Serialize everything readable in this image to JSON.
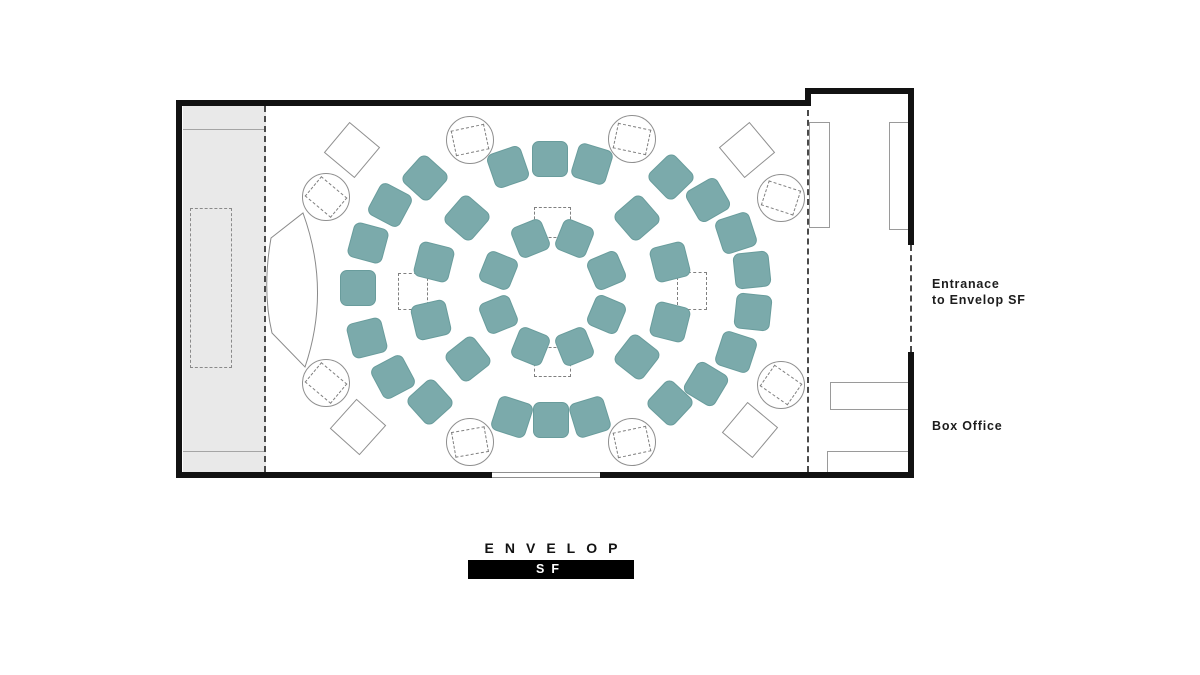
{
  "labels": {
    "entrance_line1": "Entranace",
    "entrance_line2": "to Envelop SF",
    "box_office": "Box Office",
    "logo_text": "ENVELOP",
    "logo_sub": "SF"
  },
  "colors": {
    "seat": "#7baaab",
    "seat_border": "#699c9c",
    "wall": "#121212",
    "stage": "#e9e9e9"
  },
  "floorplan": {
    "seats": [
      {
        "x": 574,
        "y": 238,
        "rot": 22,
        "s": 33
      },
      {
        "x": 606,
        "y": 270,
        "rot": 67,
        "s": 33
      },
      {
        "x": 606,
        "y": 314,
        "rot": 113,
        "s": 33
      },
      {
        "x": 574,
        "y": 346,
        "rot": 158,
        "s": 33
      },
      {
        "x": 530,
        "y": 346,
        "rot": 202,
        "s": 33
      },
      {
        "x": 498,
        "y": 314,
        "rot": 248,
        "s": 33
      },
      {
        "x": 498,
        "y": 270,
        "rot": 292,
        "s": 33
      },
      {
        "x": 530,
        "y": 238,
        "rot": 338,
        "s": 33
      },
      {
        "x": 467,
        "y": 218,
        "rot": 311,
        "s": 36
      },
      {
        "x": 434,
        "y": 262,
        "rot": 284,
        "s": 36
      },
      {
        "x": 431,
        "y": 320,
        "rot": 257,
        "s": 36
      },
      {
        "x": 468,
        "y": 359,
        "rot": 232,
        "s": 36
      },
      {
        "x": 637,
        "y": 218,
        "rot": 49,
        "s": 36
      },
      {
        "x": 670,
        "y": 262,
        "rot": 76,
        "s": 36
      },
      {
        "x": 670,
        "y": 322,
        "rot": 104,
        "s": 36
      },
      {
        "x": 637,
        "y": 357,
        "rot": 128,
        "s": 36
      },
      {
        "x": 508,
        "y": 167,
        "rot": 341,
        "s": 36
      },
      {
        "x": 550,
        "y": 159,
        "rot": 0,
        "s": 36
      },
      {
        "x": 592,
        "y": 164,
        "rot": 17,
        "s": 36
      },
      {
        "x": 671,
        "y": 177,
        "rot": 46,
        "s": 36
      },
      {
        "x": 708,
        "y": 200,
        "rot": 60,
        "s": 36
      },
      {
        "x": 736,
        "y": 233,
        "rot": 72,
        "s": 36
      },
      {
        "x": 752,
        "y": 270,
        "rot": 84,
        "s": 36
      },
      {
        "x": 753,
        "y": 312,
        "rot": 96,
        "s": 36
      },
      {
        "x": 736,
        "y": 352,
        "rot": 108,
        "s": 36
      },
      {
        "x": 706,
        "y": 384,
        "rot": 121,
        "s": 36
      },
      {
        "x": 670,
        "y": 403,
        "rot": 133,
        "s": 36
      },
      {
        "x": 590,
        "y": 417,
        "rot": 163,
        "s": 36
      },
      {
        "x": 551,
        "y": 420,
        "rot": 180,
        "s": 36
      },
      {
        "x": 512,
        "y": 417,
        "rot": 198,
        "s": 36
      },
      {
        "x": 430,
        "y": 402,
        "rot": 228,
        "s": 36
      },
      {
        "x": 393,
        "y": 377,
        "rot": 242,
        "s": 36
      },
      {
        "x": 367,
        "y": 338,
        "rot": 256,
        "s": 36
      },
      {
        "x": 358,
        "y": 288,
        "rot": 270,
        "s": 36
      },
      {
        "x": 368,
        "y": 243,
        "rot": 285,
        "s": 36
      },
      {
        "x": 390,
        "y": 205,
        "rot": 298,
        "s": 36
      },
      {
        "x": 425,
        "y": 178,
        "rot": 312,
        "s": 36
      }
    ],
    "speaker_circles": [
      {
        "x": 326,
        "y": 197,
        "rot": 40
      },
      {
        "x": 470,
        "y": 140,
        "rot": -12
      },
      {
        "x": 632,
        "y": 139,
        "rot": 12
      },
      {
        "x": 781,
        "y": 198,
        "rot": 18
      },
      {
        "x": 326,
        "y": 383,
        "rot": 40
      },
      {
        "x": 470,
        "y": 442,
        "rot": -10
      },
      {
        "x": 632,
        "y": 442,
        "rot": -12
      },
      {
        "x": 781,
        "y": 385,
        "rot": 35
      }
    ],
    "diamonds": [
      {
        "x": 352,
        "y": 150,
        "rot": 40
      },
      {
        "x": 747,
        "y": 150,
        "rot": 50
      },
      {
        "x": 358,
        "y": 427,
        "rot": 42
      },
      {
        "x": 750,
        "y": 430,
        "rot": 40
      }
    ],
    "dashed_markers": [
      {
        "x": 552,
        "y": 222,
        "w": 37,
        "h": 31
      },
      {
        "x": 552,
        "y": 362,
        "w": 37,
        "h": 30
      },
      {
        "x": 413,
        "y": 291,
        "w": 30,
        "h": 37
      },
      {
        "x": 692,
        "y": 291,
        "w": 30,
        "h": 38
      }
    ],
    "lobby_rects": [
      {
        "x": 809,
        "y": 122,
        "w": 21,
        "h": 106
      },
      {
        "x": 889,
        "y": 122,
        "w": 23,
        "h": 108
      },
      {
        "x": 830,
        "y": 382,
        "w": 83,
        "h": 28
      },
      {
        "x": 827,
        "y": 451,
        "w": 85,
        "h": 24
      }
    ],
    "stage_dashed_rect": {
      "x": 190,
      "y": 208,
      "w": 42,
      "h": 160
    }
  }
}
